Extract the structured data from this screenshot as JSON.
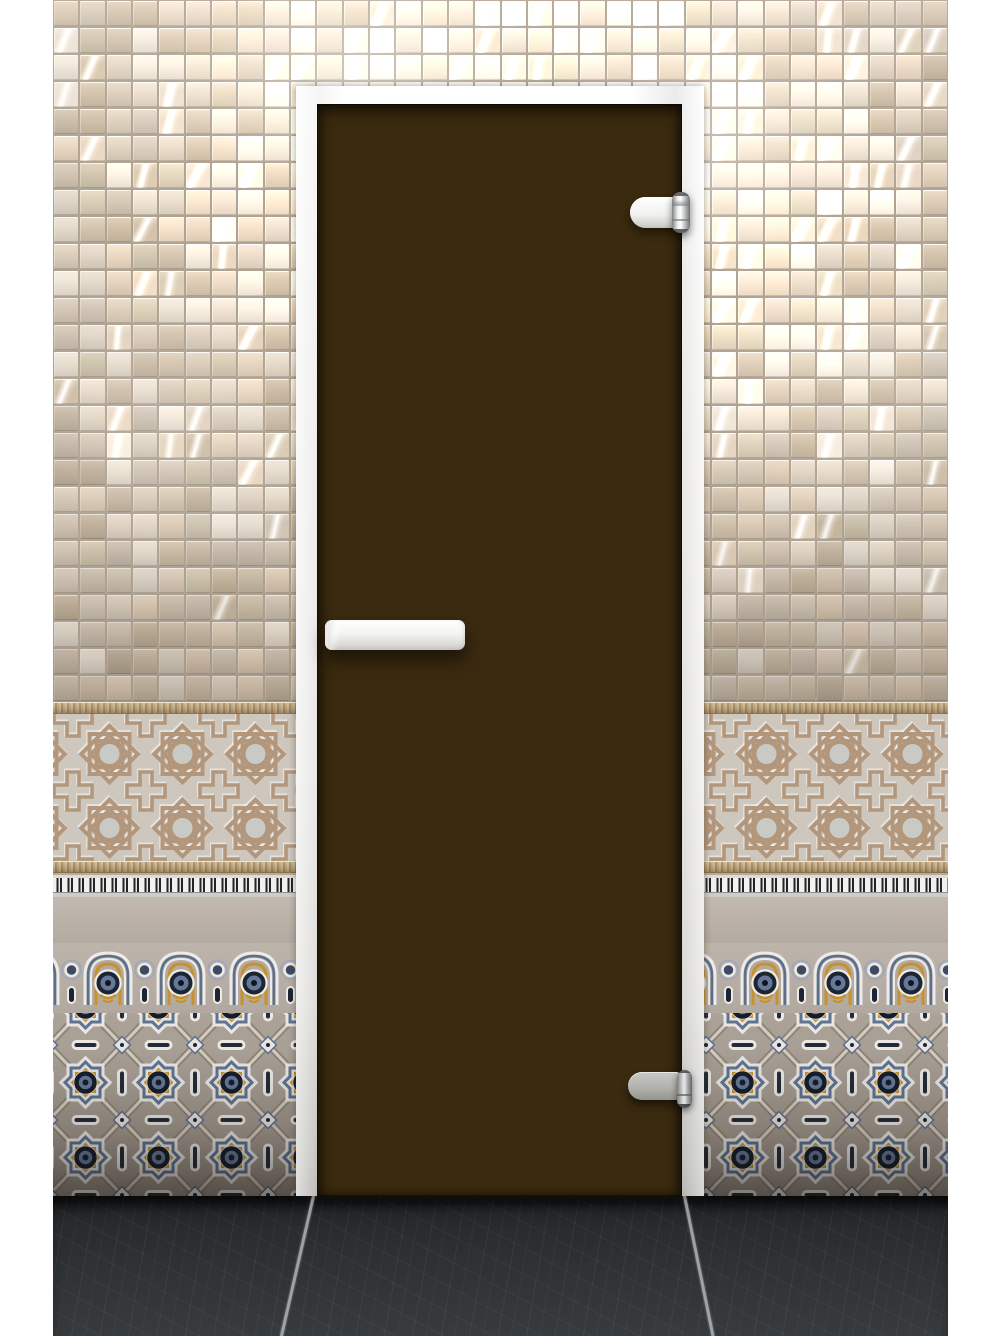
{
  "image": {
    "subject": "bronze-matte-glass-door",
    "description": "Frosted bronze glass door with white aluminium frame, white bar handle and two hinges, set in a wall of beige glossy mosaic tiles over oriental relief and ornament tile friezes, dark slate tile floor"
  },
  "door": {
    "glass_finish": "bronze-matte",
    "frame_finish": "white-aluminium",
    "handle_type": "horizontal-bar",
    "hinge_top_finish": "white-and-chrome",
    "hinge_bottom_finish": "grey-metal"
  },
  "wall": {
    "upper": "glossy-beige-square-mosaic",
    "friezes": [
      "rope-border",
      "moorish-relief-stars-and-crosses",
      "rope-border",
      "dentil-comb-band",
      "plain-band",
      "arched-niche-frieze",
      "eight-point-star-frieze"
    ]
  },
  "floor": "dark-slate-tiles",
  "colors": {
    "margin": "#ffffff",
    "grout": "#b1a392",
    "frame": "#f2f1ee",
    "glass_center": "#443112",
    "glass_edge": "#1a1105",
    "relief_bg": "#cdc7be",
    "relief_line": "#b2977c",
    "rope": "#bfa87f",
    "band_plain": "#b7aea5",
    "gold": "#c8912a",
    "blue": "#65789a",
    "navy": "#1d2533",
    "white_detail": "#e9e7e3",
    "floor_tile": "#2d3032",
    "floor_grout": "#c3c8cb",
    "handle": "#f5f4f2",
    "hinge_grey": "#a8a8a4"
  },
  "mosaic_palette": [
    "#d9cdbd",
    "#cfc2b0",
    "#c6b7a3",
    "#e0d6c8",
    "#d3c4b3",
    "#c9bdae",
    "#d8c7b2",
    "#cbbfa9",
    "#e6ddd0",
    "#c2b29c"
  ]
}
